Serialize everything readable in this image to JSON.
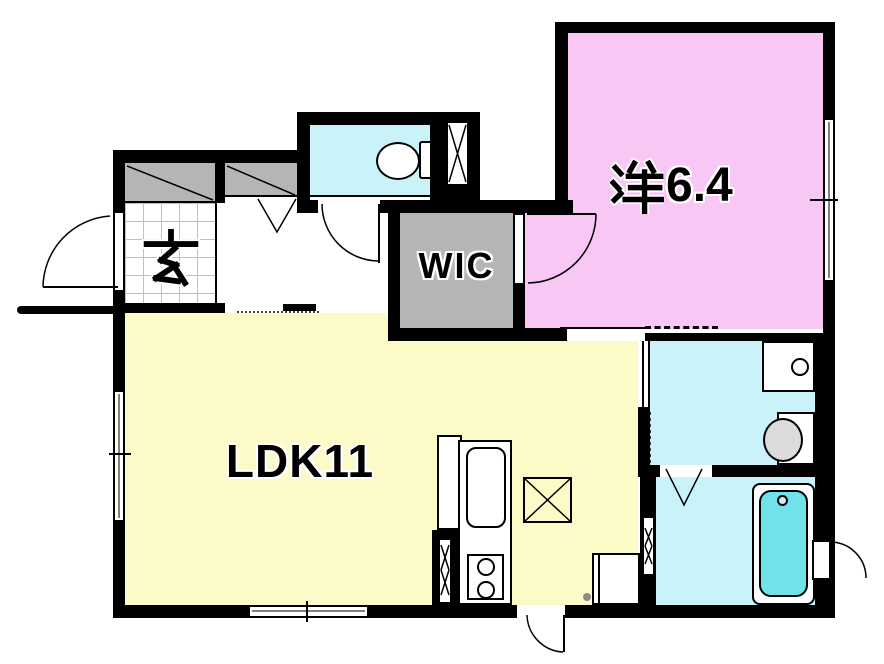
{
  "labels": {
    "entrance": "玄",
    "wic": "WIC",
    "western_room": "洋6.4",
    "western_room_kanji": "洋",
    "western_room_area": "6.4",
    "ldk": "LDK11"
  },
  "colors": {
    "western_room": "#f8c7f3",
    "ldk": "#fcfac6",
    "wet_rooms": "#c9f3f8",
    "bathtub": "#6fe3e9",
    "closet_gray": "#b5b5b5",
    "wall": "#000000",
    "vanity_bowl": "#dcdcdc",
    "background": "#ffffff"
  }
}
